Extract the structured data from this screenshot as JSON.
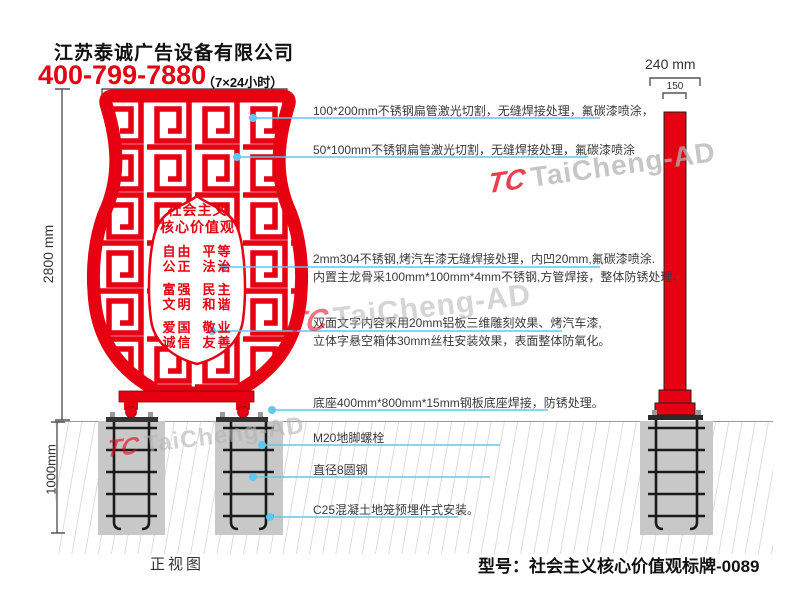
{
  "header": {
    "company": "江苏泰诚广告设备有限公司",
    "phone": "400-799-7880",
    "phone_note": "（7×24小时）"
  },
  "dimensions": {
    "side_width": "240 mm",
    "side_inner": "150",
    "front_height": "2800 mm",
    "underground_depth": "1000mm"
  },
  "sign": {
    "title_line1": "社会主义",
    "title_line2": "核心价值观",
    "values": [
      [
        "自由",
        "平等"
      ],
      [
        "公正",
        "法治"
      ],
      [
        "富强",
        "民主"
      ],
      [
        "文明",
        "和谐"
      ],
      [
        "爱国",
        "敬业"
      ],
      [
        "诚信",
        "友善"
      ]
    ]
  },
  "annotations": {
    "a1": "100*200mm不锈钢扁管激光切割，无缝焊接处理，氟碳漆喷涂，",
    "a2": "50*100mm不锈钢扁管激光切割，无缝焊接处理，氟碳漆喷涂",
    "a3_line1": "2mm304不锈钢,烤汽车漆无缝焊接处理，内凹20mm,氟碳漆喷涂.",
    "a3_line2": "内置主龙骨采100mm*100mm*4mm不锈钢,方管焊接，整体防锈处理。",
    "a4_line1": "双面文字内容采用20mm铝板三维雕刻效果、烤汽车漆,",
    "a4_line2": "立体字悬空箱体30mm丝柱安装效果，表面整体防氧化。",
    "a5": "底座400mm*800mm*15mm钢板底座焊接，防锈处理。",
    "a6": "M20地脚螺栓",
    "a7": "直径8圆钢",
    "a8": "C25混凝土地笼预埋件式安装。"
  },
  "watermark": {
    "logo": "TC",
    "text": "TaiCheng-AD"
  },
  "footer": {
    "front_view_label": "正视图",
    "model": "型号：社会主义核心价值观标牌-0089"
  },
  "colors": {
    "red": "#e60012",
    "leader_blue": "#5fc8ef",
    "concrete": "#c8c8c8",
    "watermark_gray": "#b3b3b3"
  }
}
